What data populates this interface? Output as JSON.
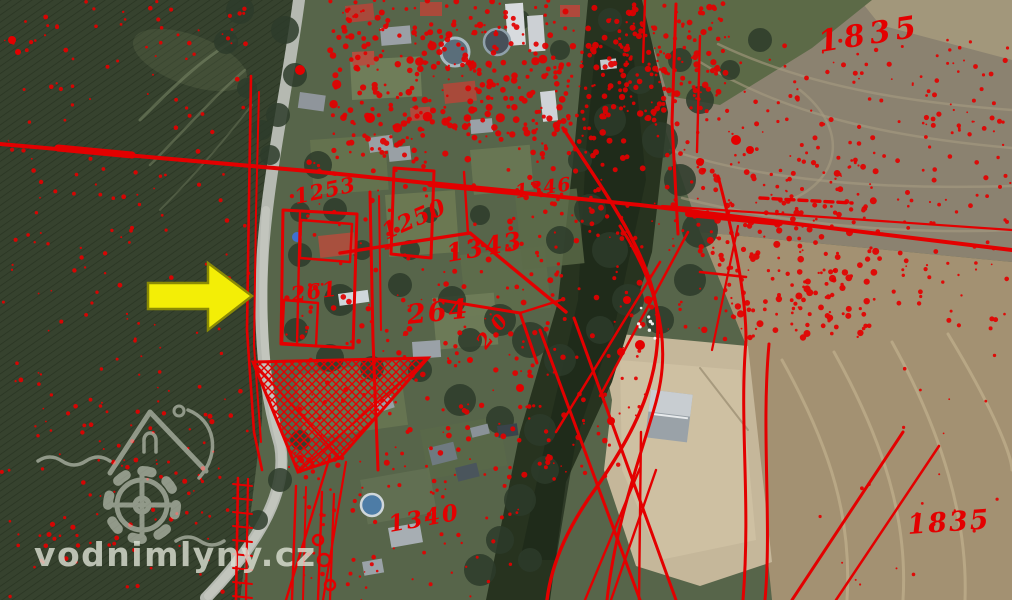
{
  "map": {
    "kind": "aerial-orthophoto-with-cadastral-overlay",
    "overlay_color": "#e30000",
    "arrow": {
      "direction": "right",
      "fill": "#f3ee06",
      "outline": "#8a8a05"
    },
    "watermark": {
      "text": "vodnimlyny.cz",
      "icon": "water-mill-house-gear-icon",
      "color": "#dde1d4"
    },
    "labels": [
      {
        "text": "1835",
        "x": 820,
        "y": 52,
        "rot": -9,
        "size": 30,
        "spacing": 5
      },
      {
        "text": "1835",
        "x": 908,
        "y": 534,
        "rot": -4,
        "size": 27,
        "spacing": 2
      },
      {
        "text": "1253",
        "x": 296,
        "y": 204,
        "rot": -12,
        "size": 21,
        "spacing": 1
      },
      {
        "text": "1250",
        "x": 386,
        "y": 240,
        "rot": -24,
        "size": 23,
        "spacing": 1
      },
      {
        "text": "1343",
        "x": 448,
        "y": 262,
        "rot": -10,
        "size": 25,
        "spacing": 2
      },
      {
        "text": "1346",
        "x": 516,
        "y": 198,
        "rot": -8,
        "size": 19,
        "spacing": 1
      },
      {
        "text": "264",
        "x": 408,
        "y": 324,
        "rot": -6,
        "size": 27,
        "spacing": 2
      },
      {
        "text": "261",
        "x": 292,
        "y": 302,
        "rot": -8,
        "size": 21,
        "spacing": 1
      },
      {
        "text": "2.0",
        "x": 486,
        "y": 350,
        "rot": -52,
        "size": 20,
        "spacing": 1
      },
      {
        "text": "1340",
        "x": 390,
        "y": 532,
        "rot": -10,
        "size": 23,
        "spacing": 2
      }
    ]
  }
}
